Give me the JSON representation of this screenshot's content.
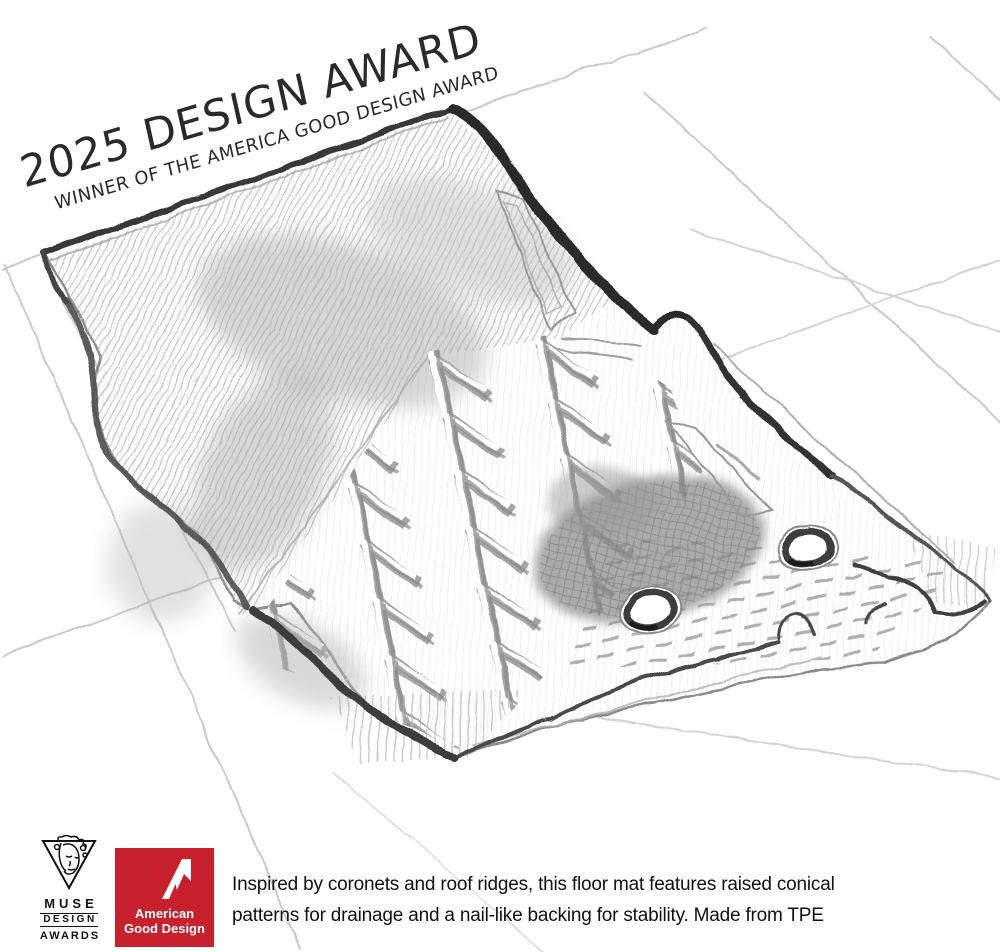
{
  "page": {
    "background": "#ffffff"
  },
  "award_overlay": {
    "line1": "2025 DESIGN AWARD",
    "line2": "WINNER OF THE AMERICA GOOD DESIGN AWARD",
    "text_color": "#2a2a2a"
  },
  "caption": {
    "line1": "Inspired by coronets and roof ridges, this floor mat features raised conical",
    "line2": "patterns for drainage and a nail-like backing for stability. Made from TPE",
    "text_color": "#111111"
  },
  "logos": {
    "muse": {
      "name": "MUSE Design Awards",
      "line1": "MUSE",
      "line2": "DESIGN",
      "line3": "AWARDS",
      "color": "#111111",
      "icon": "muse-face-in-triangle-icon"
    },
    "american_good_design": {
      "name": "American Good Design",
      "line1": "American",
      "line2": "Good Design",
      "background_color": "#C8202D",
      "text_color": "#ffffff",
      "icon": "stylized-a-icon"
    }
  },
  "illustration": {
    "subject": "Pencil sketch of a vehicle floor mat with herringbone chevron ridges, two grommets and perspective grid lines",
    "style": "graphite pencil on white",
    "grommet_count": 2,
    "pencil_color": "#3a3a3a",
    "grid_line_color": "#b5b5b5"
  }
}
